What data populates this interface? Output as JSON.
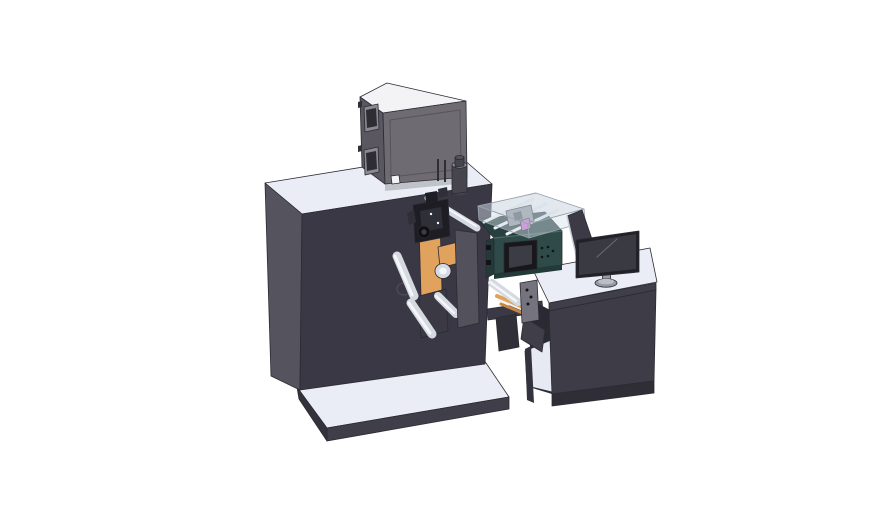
{
  "scene": {
    "description": "3D CAD render of an industrial label printing / coating machine line: electrical box on a large cabinet, web unwind mechanism with rollers, process unit with touchscreen and transparent cover, transfer arm, operator desk with monitor, on a base platform.",
    "background": "#ffffff",
    "components": [
      "electrical-control-box",
      "main-cabinet",
      "base-platform",
      "exhaust-cylinder",
      "unwind-mechanism",
      "print-head",
      "front-cover-plate",
      "process-unit",
      "touchscreen",
      "transparent-cover",
      "transfer-arm",
      "operator-desk",
      "monitor",
      "monitor-back-panel"
    ]
  },
  "colors": {
    "surface": "#eaedf5",
    "platformEdge": "#3f3e49",
    "platformEdgeDark": "#34333d",
    "cabinetFront": "#3a3844",
    "cabinetSide": "#54535e",
    "boxTop": "#f3f3f5",
    "boxFront": "#6f6b73",
    "boxSide": "#5a5761",
    "windowFrame": "#8a8891",
    "windowGlass": "#2e2d34",
    "shadow": "rgba(0,0,0,0.18)",
    "cylinder": "#46454d",
    "cylinderCap": "#8d8b93",
    "cylinderTop": "#55535c",
    "tealFront": "#2e4a49",
    "tealSide": "#223a39",
    "tealTop": "#27403f",
    "tealLine": "#4d6b69",
    "bezel": "#17171c",
    "screen": "#3c3c45",
    "orange": "#e0a25c",
    "orangeDark": "#c9873f",
    "roller": "#d5d9e1",
    "rollerHi": "#f4f6f9",
    "black0": "#0f0f13",
    "black1": "#1d1d23",
    "black2": "#2f2f38",
    "darkPart": "#3a3944",
    "coverPlate": "#52515c",
    "holedPlate": "#75737d",
    "armBar": "#3a3945",
    "armSupport": "#313039",
    "chute": "#3f3e49",
    "deskFront": "#3d3c47",
    "deskBase": "#2f2e37",
    "deskLeg": "#34333d",
    "deskInner": "#2b2a33",
    "shelf": "#e7eaf2",
    "monitorBezel": "#222127",
    "monitorScreen": "#3a3a43",
    "reflect": "#6a6a75",
    "stand": "#959aa3",
    "standHi": "#b9bec7",
    "panelBack": "#3c3b45",
    "panelEdge": "#c9cdd5",
    "glass": "rgba(203,214,224,0.55)",
    "glassSide": "rgba(216,226,234,0.45)",
    "rail": "#eef1f5",
    "innerGray": "#8e939b",
    "innerDark": "#4a4e55",
    "magenta": "#c468c8",
    "dot": "#141418"
  }
}
